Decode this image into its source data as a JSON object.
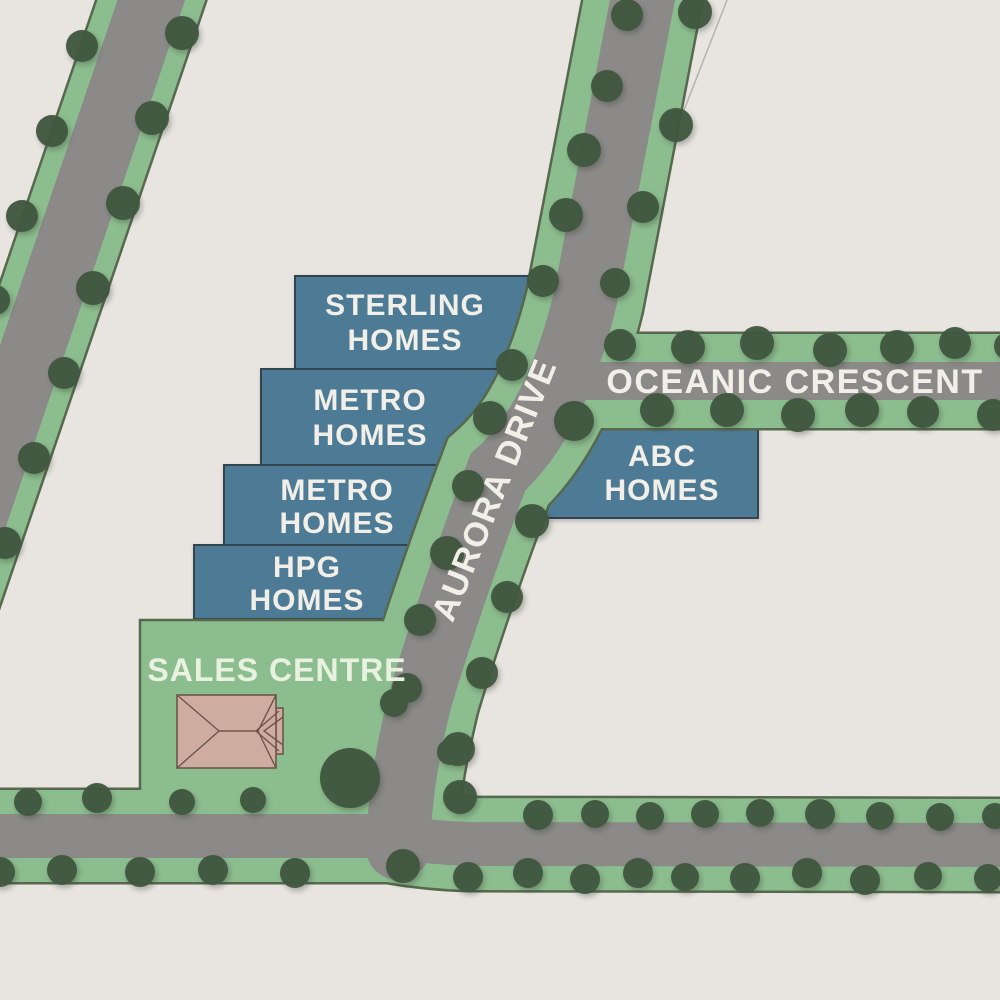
{
  "map_title": "Residential estate site plan",
  "colors": {
    "background": "#e8e5e0",
    "verge_green": "#8cbd8e",
    "road_gray": "#8b8a88",
    "green_outline": "#57684f",
    "tree_green": "#41573f",
    "parcel_blue": "#4d7b95",
    "parcel_stroke": "#33444e",
    "label_white": "#f2efe8",
    "sales_label_green_white": "#e9f2e1",
    "roof_pink": "#cfaca0",
    "roof_outline": "#6f564c"
  },
  "parcels": [
    {
      "id": "sterling-homes",
      "line1": "STERLING",
      "line2": "HOMES"
    },
    {
      "id": "metro-homes-north",
      "line1": "METRO",
      "line2": "HOMES"
    },
    {
      "id": "metro-homes-south",
      "line1": "METRO",
      "line2": "HOMES"
    },
    {
      "id": "hpg-homes",
      "line1": "HPG",
      "line2": "HOMES"
    },
    {
      "id": "abc-homes",
      "line1": "ABC",
      "line2": "HOMES"
    }
  ],
  "sales_centre": {
    "label": "SALES CENTRE"
  },
  "roads": {
    "aurora": "AURORA DRIVE",
    "oceanic": "OCEANIC CRESCENT"
  }
}
